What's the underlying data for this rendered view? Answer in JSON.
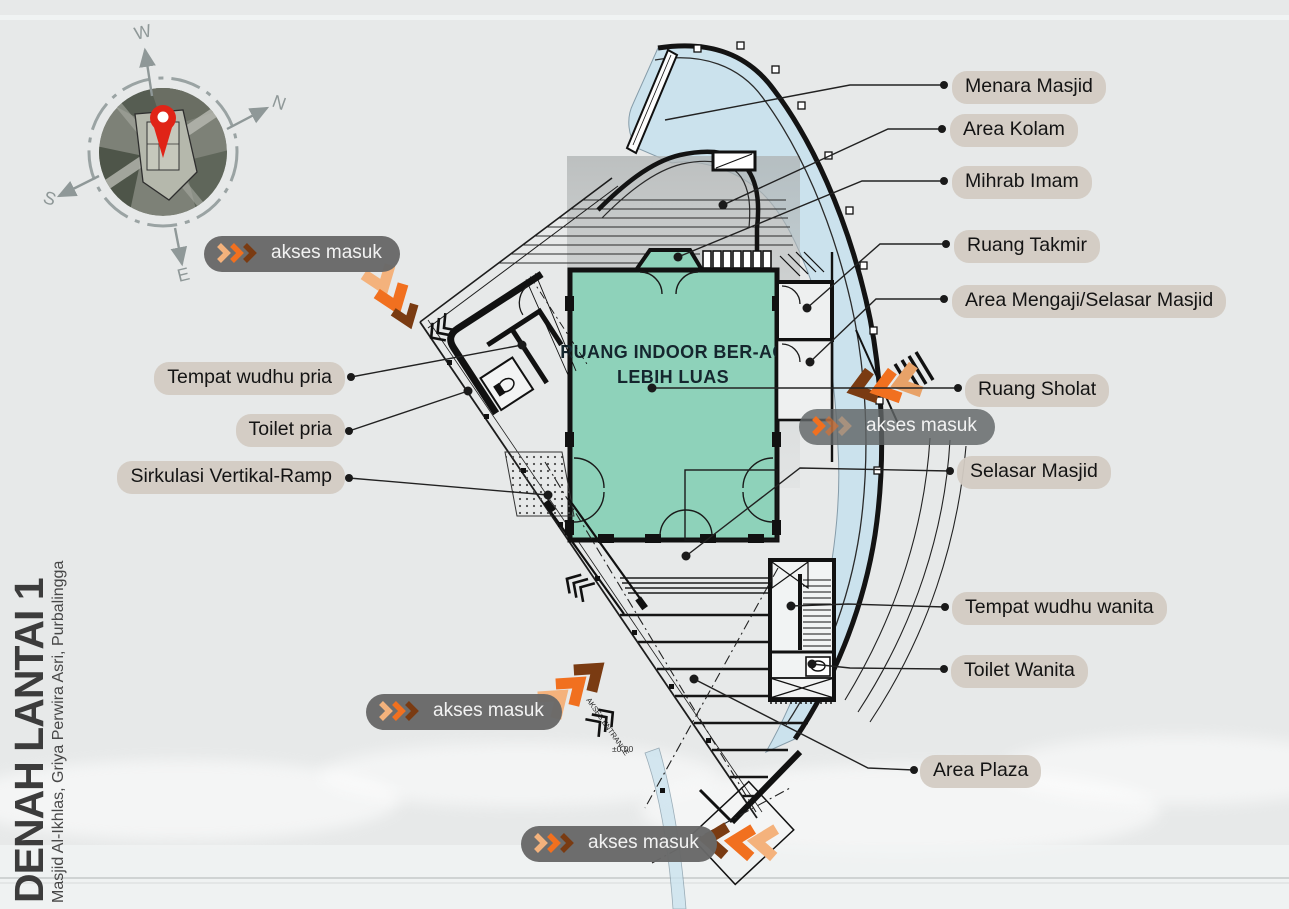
{
  "page": {
    "title": "DENAH LANTAI 1",
    "subtitle": "Masjid Al-Ikhlas, Griya Perwira Asri, Purbalingga"
  },
  "compass": {
    "west": "W",
    "north": "N",
    "south": "S",
    "east": "E"
  },
  "plan": {
    "room_line1": "RUANG INDOOR BER-AC",
    "room_line2": "LEBIH LUAS",
    "elevation": "±0.00",
    "entrance_note": "AKSES ENTRANCE"
  },
  "badges": {
    "label": "akses masuk"
  },
  "labels_right": [
    {
      "text": "Menara Masjid"
    },
    {
      "text": "Area Kolam"
    },
    {
      "text": "Mihrab Imam"
    },
    {
      "text": "Ruang Takmir"
    },
    {
      "text": "Area Mengaji/Selasar Masjid"
    },
    {
      "text": "Ruang Sholat"
    },
    {
      "text": "Selasar Masjid"
    },
    {
      "text": "Tempat wudhu wanita"
    },
    {
      "text": "Toilet Wanita"
    },
    {
      "text": "Area Plaza"
    }
  ],
  "labels_left": [
    {
      "text": "Tempat wudhu pria"
    },
    {
      "text": "Toilet pria"
    },
    {
      "text": "Sirkulasi Vertikal-Ramp"
    }
  ],
  "colors": {
    "background": "#e7e9e9",
    "pill_background": "#d3cbc3",
    "badge_background": "#686868",
    "prayer_room_fill": "#8ed2ba",
    "pool_blue": "#c9e2ee",
    "chevron_light": "#f4b27c",
    "chevron_orange": "#f1701f",
    "chevron_brown": "#7a3b12",
    "pin_red": "#e02417"
  }
}
